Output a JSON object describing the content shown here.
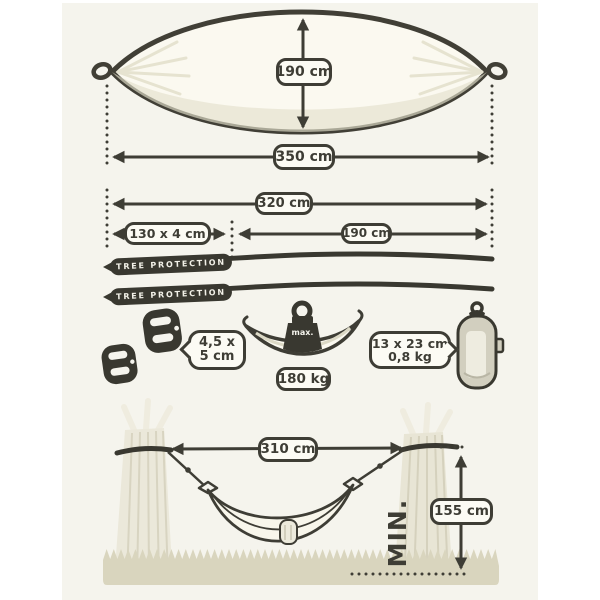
{
  "top_view": {
    "height": "190 cm",
    "length": "350 cm"
  },
  "suspension": {
    "total": "320 cm",
    "strap": "130 x 4 cm",
    "bed": "190 cm",
    "strap_name": "TREE PROTECTION"
  },
  "accessories": {
    "carabiner_size_l1": "4,5 x",
    "carabiner_size_l2": "5 cm",
    "weight_cap": "max.",
    "max_load": "180 kg",
    "pack_size_l1": "13 x 23 cm",
    "pack_size_l2": "0,8 kg"
  },
  "setup": {
    "tree_distance": "310 cm",
    "mount_height": "155 cm",
    "min": "MIN."
  },
  "colors": {
    "ink": "#3e3d35",
    "panel": "#f5f4ed",
    "fabric": "#fbf9f0",
    "ground": "#d9d5be"
  }
}
